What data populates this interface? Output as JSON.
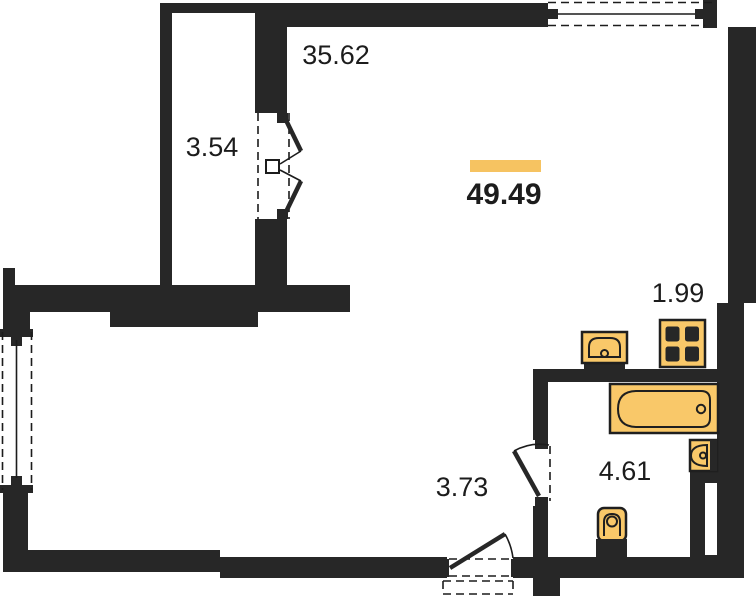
{
  "plan": {
    "type": "apartment-floor-plan",
    "total_area": "49.49",
    "rooms": [
      {
        "name": "living-room",
        "area": "35.62"
      },
      {
        "name": "balcony",
        "area": "3.54"
      },
      {
        "name": "kitchen-niche",
        "area": "1.99"
      },
      {
        "name": "hallway",
        "area": "3.73"
      },
      {
        "name": "bathroom",
        "area": "4.61"
      }
    ],
    "fixtures": [
      "kitchen-sink",
      "stove",
      "bathtub",
      "washbasin",
      "toilet"
    ],
    "colors": {
      "wall": "#272727",
      "fixture": "#F9C869",
      "fixture_stroke": "#1f1f1f",
      "highlight": "#F6C361",
      "text": "#1c1c1c",
      "bg": "#ffffff"
    }
  }
}
